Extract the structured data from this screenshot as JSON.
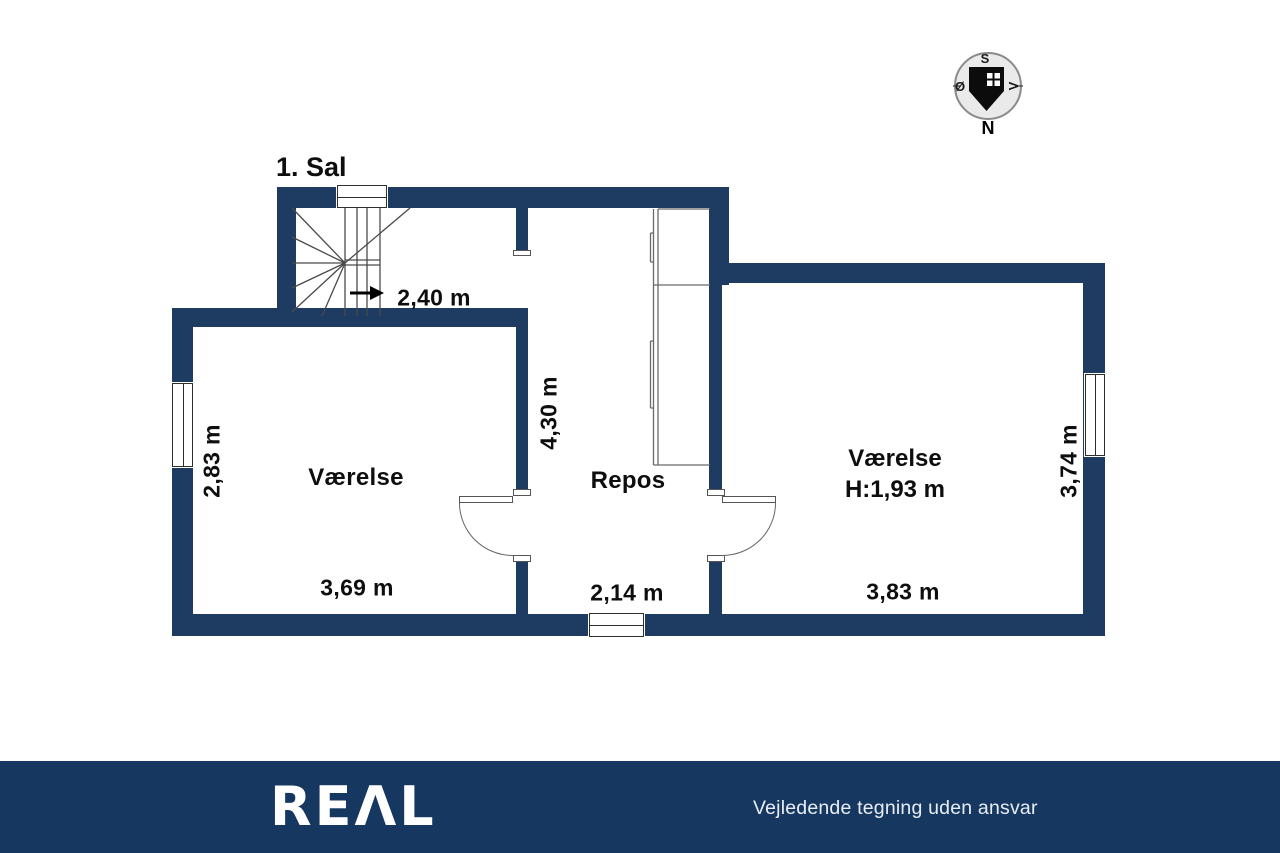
{
  "floorplan": {
    "title": "1. Sal",
    "rooms": {
      "left_room": {
        "label": "Værelse",
        "width_label": "3,69 m",
        "depth_label": "2,83 m"
      },
      "landing": {
        "label": "Repos",
        "width_label": "2,14 m",
        "depth_label": "4,30 m"
      },
      "right_room": {
        "label": "Værelse",
        "ceiling_height_label": "H:1,93 m",
        "width_label": "3,83 m",
        "depth_label": "3,74 m"
      },
      "staircase": {
        "width_label": "2,40 m"
      }
    },
    "compass": {
      "top": "S",
      "left": "Ø",
      "right": "V",
      "bottom": "N"
    }
  },
  "footer": {
    "logo_text": "REΛL",
    "disclaimer": "Vejledende tegning uden ansvar"
  },
  "colors": {
    "wall": "#1e3c62",
    "footer_bar": "#16375f"
  }
}
